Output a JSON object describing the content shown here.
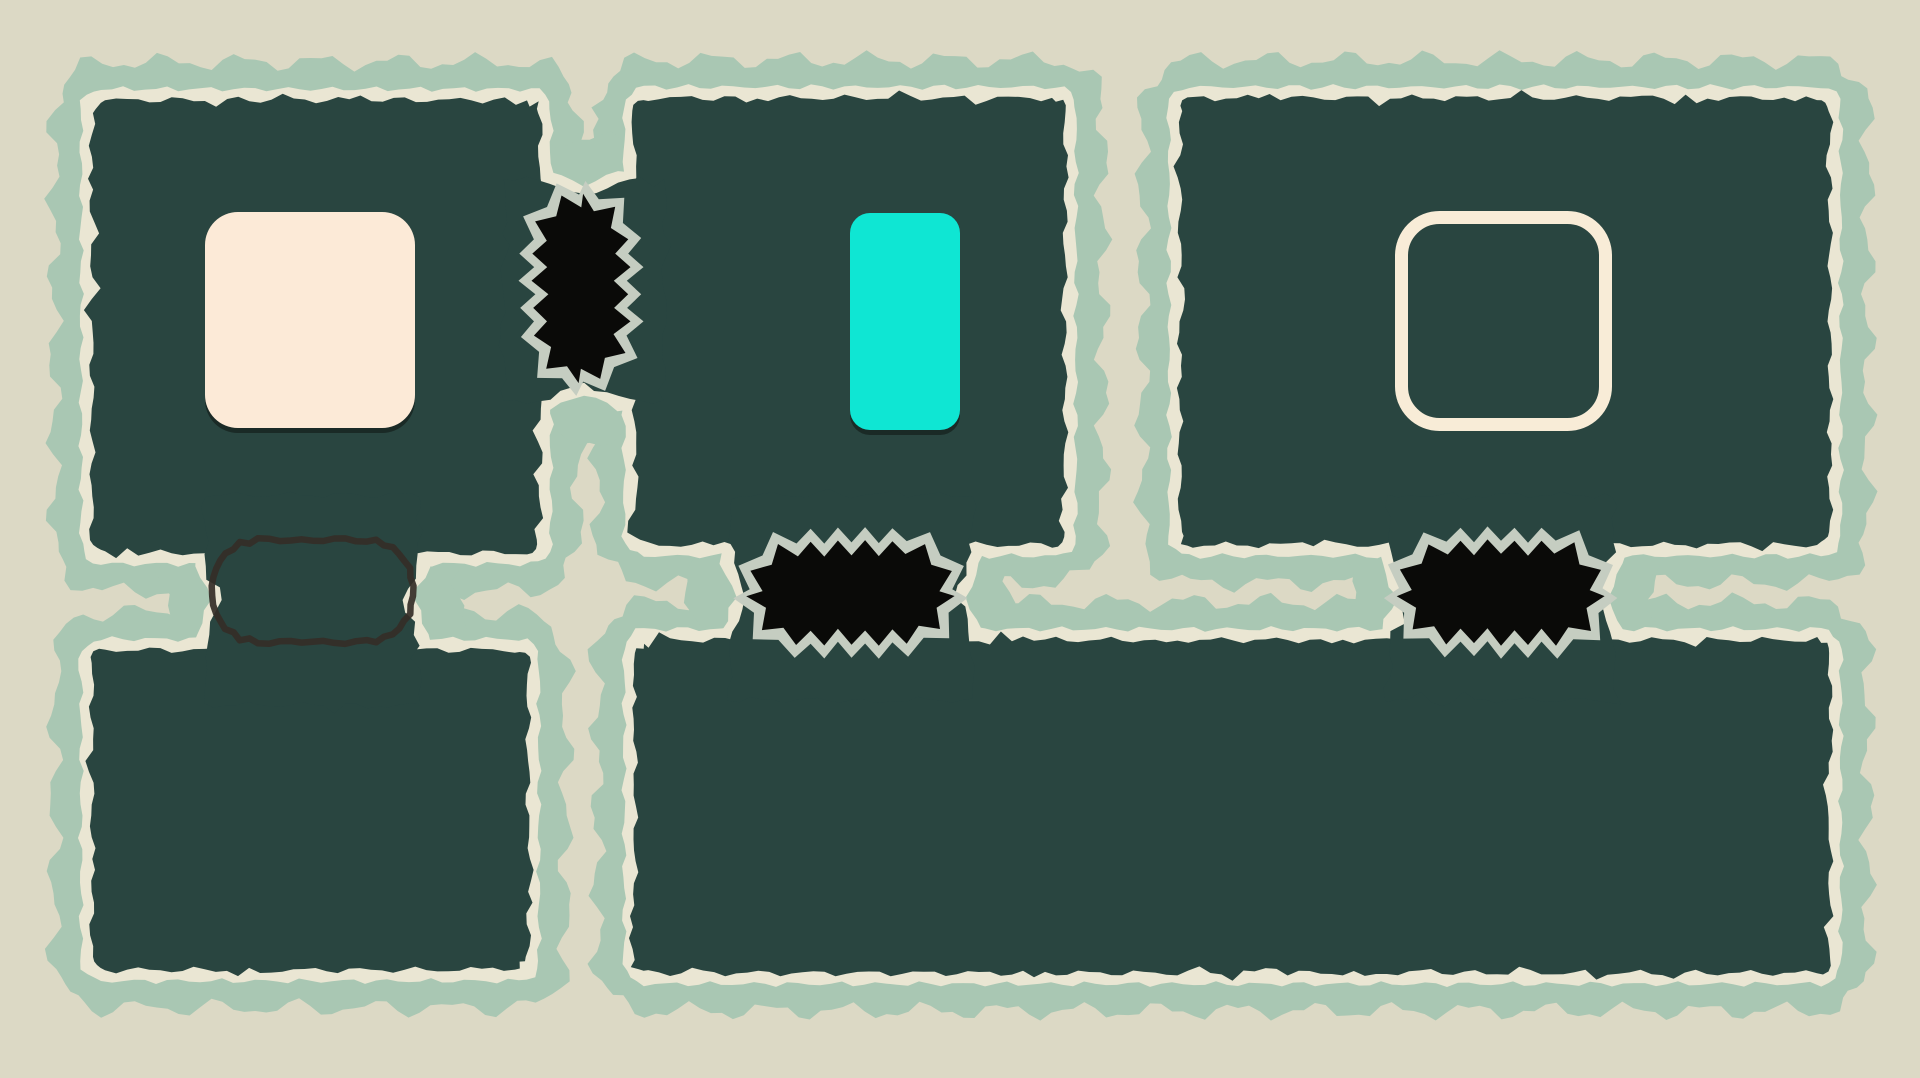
{
  "scene": {
    "width": 1920,
    "height": 1078,
    "title": "puzzle-room-map"
  },
  "colors": {
    "background": "#dcd9c5",
    "halo": "#a9c7b3",
    "rim": "#eae6d3",
    "panel": "#294540",
    "hole_fill": "#0a0a08",
    "hole_ring": "#c5cdc1",
    "ghost_stroke": "#342e27",
    "piece_shadow": "#17231f",
    "cream_piece": "#fcead7",
    "cyan_piece": "#0fe6d3",
    "goal_stroke": "#f8ecd7"
  },
  "style": {
    "halo_expand": 38,
    "halo_amp": 10,
    "halo_wl": 78,
    "rim_expand": 11,
    "rim_amp": 3,
    "rim_wl": 42,
    "panel_amp": 3.5,
    "panel_wl": 55,
    "ring_width": 13,
    "ring_amp": 7.5,
    "ring_step": 13,
    "ghost_amp": 2.2,
    "ghost_wl": 15,
    "ghost_stroke_width": 6.5
  },
  "panels": [
    {
      "id": "panel-top-left",
      "x": 92,
      "y": 100,
      "w": 448,
      "h": 453
    },
    {
      "id": "panel-top-middle",
      "x": 635,
      "y": 98,
      "w": 430,
      "h": 447
    },
    {
      "id": "panel-top-right",
      "x": 1180,
      "y": 98,
      "w": 650,
      "h": 447
    },
    {
      "id": "panel-bottom-left",
      "x": 92,
      "y": 650,
      "w": 436,
      "h": 320
    },
    {
      "id": "panel-bottom-wide",
      "x": 635,
      "y": 640,
      "w": 1195,
      "h": 333
    }
  ],
  "bridges": [
    {
      "id": "bridge-top-link",
      "x": 503,
      "y": 178,
      "w": 162,
      "h": 224,
      "axis": "v"
    },
    {
      "id": "bridge-mid-left-link",
      "x": 728,
      "y": 495,
      "w": 246,
      "h": 205,
      "axis": "h"
    },
    {
      "id": "bridge-mid-right-link",
      "x": 1388,
      "y": 495,
      "w": 228,
      "h": 205,
      "axis": "h"
    },
    {
      "id": "bridge-ghost-link",
      "x": 203,
      "y": 495,
      "w": 219,
      "h": 210,
      "axis": "h"
    }
  ],
  "holes": [
    {
      "id": "void-hole-top",
      "x": 540,
      "y": 200,
      "w": 82,
      "h": 175,
      "r": 40
    },
    {
      "id": "void-hole-mid-left",
      "x": 755,
      "y": 548,
      "w": 193,
      "h": 89,
      "r": 42
    },
    {
      "id": "void-hole-mid-right",
      "x": 1405,
      "y": 547,
      "w": 192,
      "h": 90,
      "r": 42
    }
  ],
  "ghost_slot": {
    "id": "ghost-slot",
    "x": 212,
    "y": 540,
    "w": 201,
    "h": 102,
    "r": 46
  },
  "pieces": {
    "cream_box": {
      "id": "cream-box-piece",
      "x": 205,
      "y": 212,
      "w": 210,
      "h": 216,
      "r": 33
    },
    "cyan_box": {
      "id": "cyan-box-piece",
      "x": 850,
      "y": 213,
      "w": 110,
      "h": 217,
      "r": 20
    },
    "goal_outline": {
      "id": "goal-outline",
      "x": 1395,
      "y": 211,
      "w": 217,
      "h": 220,
      "r": 38,
      "stroke_width": 13
    }
  }
}
